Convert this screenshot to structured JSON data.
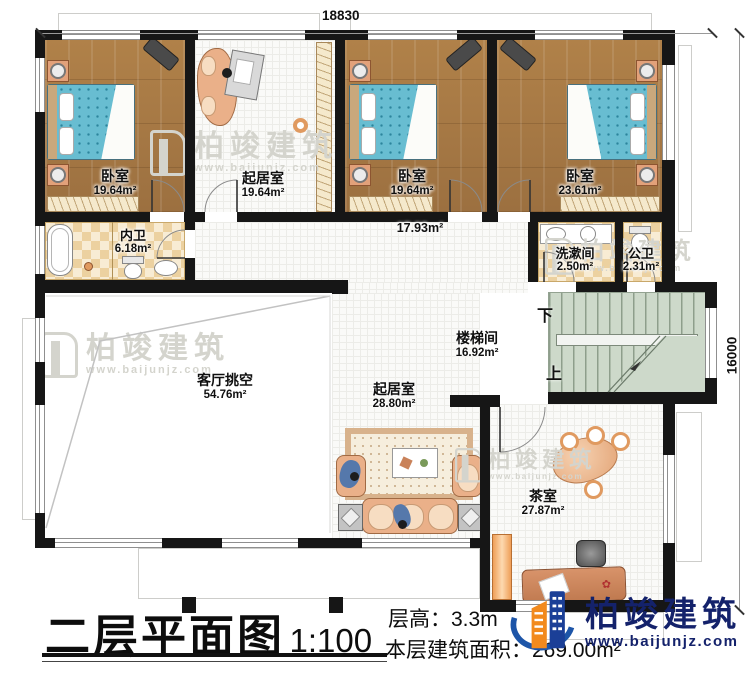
{
  "dimensions": {
    "top": "18830",
    "right": "16000"
  },
  "rooms": {
    "bedroom1": {
      "name": "卧室",
      "area": "19.64m²"
    },
    "lounge_top": {
      "name": "起居室",
      "area": "19.64m²"
    },
    "bedroom2": {
      "name": "卧室",
      "area": "19.64m²"
    },
    "bedroom3": {
      "name": "卧室",
      "area": "23.61m²"
    },
    "inner_bath": {
      "name": "内卫",
      "area": "6.18m²"
    },
    "corridor": {
      "area": "17.93m²"
    },
    "washroom": {
      "name": "洗漱间",
      "area": "2.50m²"
    },
    "public_bath": {
      "name": "公卫",
      "area": "2.31m²"
    },
    "stairwell": {
      "name": "楼梯间",
      "area": "16.92m²",
      "down": "下",
      "up": "上"
    },
    "void": {
      "name": "客厅挑空",
      "area": "54.76m²"
    },
    "lounge_main": {
      "name": "起居室",
      "area": "28.80m²"
    },
    "tearoom": {
      "name": "茶室",
      "area": "27.87m²"
    }
  },
  "footer": {
    "title": "二层平面图",
    "scale": "1:100",
    "floor_height": "层高：3.3m",
    "floor_area": "本层建筑面积：269.00m²"
  },
  "brand": {
    "name": "柏竣建筑",
    "url": "www.baijunjz.com"
  },
  "watermark": {
    "name": "柏竣建筑",
    "url": "www.baijunjz.com"
  }
}
